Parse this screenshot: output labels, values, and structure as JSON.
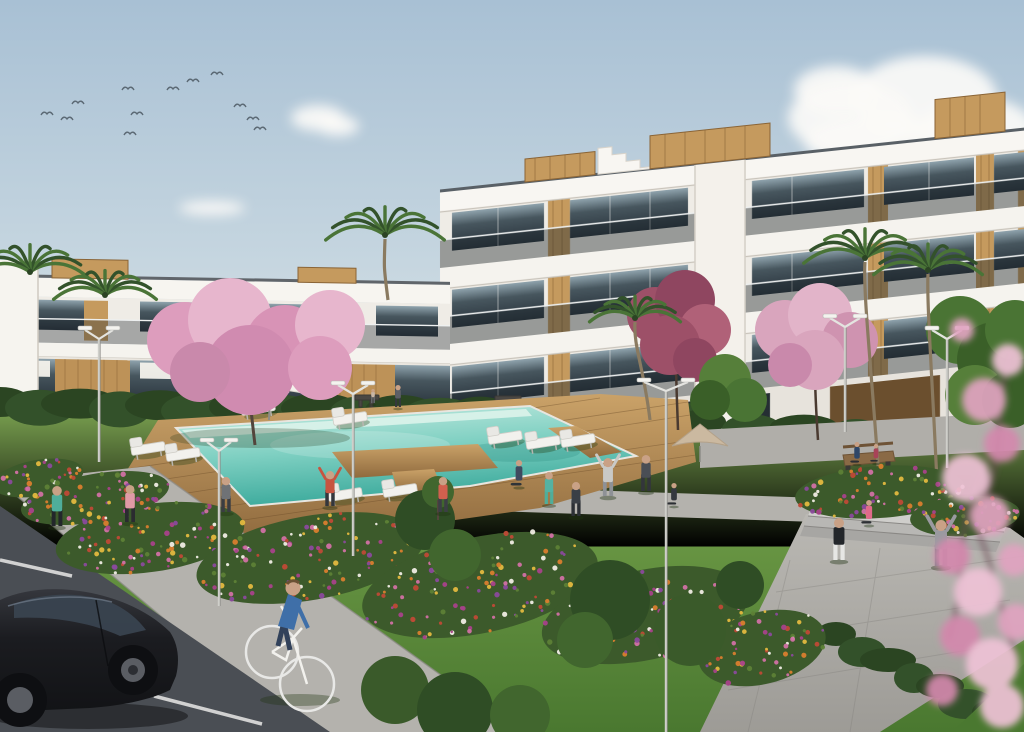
{
  "scene": {
    "description": "3D architectural rendering of a white modern apartment complex with communal lawn, swimming pool, flower beds, parking and people exercising"
  },
  "palette": {
    "sky_top": "#a8c0d4",
    "sky_mid": "#c6d6e0",
    "sky_horizon": "#e8ecec",
    "cloud": "#fbfaf7",
    "building_white": "#f6f4f0",
    "building_wall": "#efece6",
    "building_shadow": "#e3dfd8",
    "fascia": "#f8f6f2",
    "coping": "#596066",
    "glass_dark": "#2e3a41",
    "glass_light": "#9fb2ba",
    "wood": "#c59a5e",
    "wood_dark": "#8a6436",
    "lawn_light": "#83ad53",
    "lawn_dark": "#477530",
    "hedge_a": "#33512a",
    "hedge_b": "#2b4522",
    "flower_base": "#3c5a2b",
    "pool_light": "#c9ece3",
    "pool_deep": "#3fae9f",
    "pool_shelf": "#dff4ec",
    "deck_light": "#bf955f",
    "deck_dark": "#8f6a3e",
    "path_light": "#b6b4af",
    "path_mid": "#a5a39e",
    "asphalt": "#4a4e54",
    "paint_line": "#e9e9e7",
    "blossom_light": "#e7b6cd",
    "blossom_mid": "#d893b6",
    "blossom_deep": "#c06d96",
    "magenta_tree": "#9d5068",
    "car_body": "#1b1c20",
    "skin": "#c9a186"
  },
  "flower_colors": [
    "#d97e2e",
    "#e3b93f",
    "#d171a4",
    "#a8428a",
    "#bf4a36",
    "#f0ede4",
    "#8a4a9c",
    "#5d8136"
  ],
  "birds": [
    [
      47,
      113
    ],
    [
      67,
      118
    ],
    [
      78,
      102
    ],
    [
      128,
      88
    ],
    [
      137,
      113
    ],
    [
      173,
      88
    ],
    [
      193,
      80
    ],
    [
      240,
      105
    ],
    [
      253,
      118
    ],
    [
      130,
      133
    ],
    [
      217,
      73
    ],
    [
      260,
      128
    ]
  ],
  "clouds": [
    {
      "cx": 850,
      "cy": 118,
      "rx": 62,
      "ry": 36
    },
    {
      "cx": 925,
      "cy": 98,
      "rx": 72,
      "ry": 42
    },
    {
      "cx": 978,
      "cy": 128,
      "rx": 56,
      "ry": 30
    },
    {
      "cx": 888,
      "cy": 142,
      "rx": 84,
      "ry": 26
    },
    {
      "cx": 836,
      "cy": 90,
      "rx": 42,
      "ry": 24
    },
    {
      "cx": 588,
      "cy": 222,
      "rx": 42,
      "ry": 15
    },
    {
      "cx": 642,
      "cy": 215,
      "rx": 46,
      "ry": 17
    },
    {
      "cx": 692,
      "cy": 226,
      "rx": 36,
      "ry": 12
    },
    {
      "cx": 616,
      "cy": 233,
      "rx": 52,
      "ry": 11
    },
    {
      "cx": 318,
      "cy": 118,
      "rx": 27,
      "ry": 13
    },
    {
      "cx": 338,
      "cy": 126,
      "rx": 21,
      "ry": 10
    },
    {
      "cx": 212,
      "cy": 208,
      "rx": 33,
      "ry": 7
    },
    {
      "cx": 1004,
      "cy": 250,
      "rx": 46,
      "ry": 12
    }
  ],
  "hedges": [
    {
      "x0": 0,
      "x1": 700,
      "y": 404,
      "rx": 31,
      "ry": 15,
      "slope": 0.02,
      "step": 40
    },
    {
      "x0": 700,
      "x1": 1030,
      "y": 424,
      "rx": 26,
      "ry": 12,
      "slope": 0.045,
      "step": 52
    },
    {
      "x0": 836,
      "x1": 1030,
      "y": 636,
      "rx": 20,
      "ry": 12,
      "slope": 0.5,
      "step": 26
    }
  ],
  "flower_beds": [
    {
      "cx": 150,
      "cy": 538,
      "rx": 95,
      "ry": 34,
      "rot": -8,
      "n": 90
    },
    {
      "cx": 310,
      "cy": 558,
      "rx": 115,
      "ry": 42,
      "rot": -10,
      "n": 110
    },
    {
      "cx": 480,
      "cy": 585,
      "rx": 120,
      "ry": 48,
      "rot": -12,
      "n": 120
    },
    {
      "cx": 645,
      "cy": 615,
      "rx": 105,
      "ry": 45,
      "rot": -12,
      "n": 100
    },
    {
      "cx": 762,
      "cy": 648,
      "rx": 65,
      "ry": 36,
      "rot": -14,
      "n": 60
    },
    {
      "cx": 95,
      "cy": 498,
      "rx": 75,
      "ry": 24,
      "rot": -10,
      "n": 60
    },
    {
      "cx": 38,
      "cy": 478,
      "rx": 46,
      "ry": 18,
      "rot": -10,
      "n": 35
    },
    {
      "cx": 880,
      "cy": 492,
      "rx": 85,
      "ry": 26,
      "rot": -4,
      "n": 70
    },
    {
      "cx": 965,
      "cy": 516,
      "rx": 55,
      "ry": 20,
      "rot": -4,
      "n": 40
    }
  ],
  "loungers": [
    {
      "x": 258,
      "y": 408
    },
    {
      "x": 350,
      "y": 418
    },
    {
      "x": 148,
      "y": 448
    },
    {
      "x": 183,
      "y": 454
    },
    {
      "x": 505,
      "y": 437
    },
    {
      "x": 543,
      "y": 442
    },
    {
      "x": 345,
      "y": 494
    },
    {
      "x": 400,
      "y": 490
    },
    {
      "x": 578,
      "y": 440
    }
  ],
  "parking_lines": [
    [
      0,
      560,
      72,
      576
    ],
    [
      154,
      696,
      262,
      724
    ],
    [
      0,
      646,
      36,
      654
    ]
  ],
  "lamps": [
    {
      "x": 99,
      "top": 330,
      "bottom": 462,
      "arm": 14
    },
    {
      "x": 219,
      "top": 442,
      "bottom": 606,
      "arm": 12
    },
    {
      "x": 353,
      "top": 385,
      "bottom": 556,
      "arm": 15
    },
    {
      "x": 666,
      "top": 382,
      "bottom": 732,
      "arm": 22
    },
    {
      "x": 845,
      "top": 318,
      "bottom": 432,
      "arm": 15
    },
    {
      "x": 947,
      "top": 330,
      "bottom": 468,
      "arm": 15
    }
  ],
  "people": [
    {
      "name": "jogger-teal",
      "x": 57,
      "y": 526,
      "h": 40,
      "shirt": "#4fae9b",
      "pants": "#23272b",
      "type": "stand"
    },
    {
      "name": "jogger-pink",
      "x": 130,
      "y": 522,
      "h": 37,
      "shirt": "#e09aa6",
      "pants": "#2b2b30",
      "type": "stand"
    },
    {
      "name": "walker-deck",
      "x": 226,
      "y": 512,
      "h": 35,
      "shirt": "#6f7276",
      "pants": "#3a3d42",
      "type": "stand"
    },
    {
      "name": "stretcher-red",
      "x": 330,
      "y": 506,
      "h": 35,
      "shirt": "#c75440",
      "pants": "#33363c",
      "type": "armsup"
    },
    {
      "name": "walker-coral",
      "x": 443,
      "y": 512,
      "h": 35,
      "shirt": "#d2604e",
      "pants": "#3c3f45",
      "type": "stand"
    },
    {
      "name": "lounger-sitter",
      "x": 519,
      "y": 486,
      "h": 26,
      "shirt": "#3f4a5f",
      "pants": "#2e3338",
      "type": "seated"
    },
    {
      "name": "exerciser-teal",
      "x": 549,
      "y": 504,
      "h": 32,
      "shirt": "#54b2a2",
      "pants": "#4fae9b",
      "type": "stand"
    },
    {
      "name": "exerciser-track",
      "x": 576,
      "y": 516,
      "h": 34,
      "shirt": "#3a3f46",
      "pants": "#2c3036",
      "type": "stand"
    },
    {
      "name": "stretcher-hoodie",
      "x": 608,
      "y": 496,
      "h": 38,
      "shirt": "#c9c9c6",
      "pants": "#8e9196",
      "type": "armsup"
    },
    {
      "name": "exerciser-shorts",
      "x": 646,
      "y": 491,
      "h": 36,
      "shirt": "#4a4e55",
      "pants": "#33363b",
      "type": "stand"
    },
    {
      "name": "yoga-sitter",
      "x": 674,
      "y": 505,
      "h": 22,
      "shirt": "#34383f",
      "pants": "#2b2e33",
      "type": "seated"
    },
    {
      "name": "sitter-pink",
      "x": 869,
      "y": 524,
      "h": 24,
      "shirt": "#e06a8a",
      "pants": "#2e3135",
      "type": "seated"
    },
    {
      "name": "stander-black",
      "x": 839,
      "y": 560,
      "h": 42,
      "shirt": "#23262a",
      "pants": "#e6e6e4",
      "type": "stand"
    },
    {
      "name": "cheerer-gray",
      "x": 941,
      "y": 566,
      "h": 46,
      "shirt": "#9a9aa0",
      "pants": "#7e8187",
      "type": "armsup"
    },
    {
      "name": "bench-sitter-navy",
      "x": 857,
      "y": 463,
      "h": 21,
      "shirt": "#2e4668",
      "pants": "#2b2e33",
      "type": "seated"
    },
    {
      "name": "bench-sitter-red",
      "x": 876,
      "y": 462,
      "h": 18,
      "shirt": "#a84358",
      "pants": "#2b2e33",
      "type": "seated"
    },
    {
      "name": "distant-walker",
      "x": 398,
      "y": 407,
      "h": 22,
      "shirt": "#5d5f66",
      "pants": "#35383d",
      "type": "stand"
    },
    {
      "name": "distant-child",
      "x": 373,
      "y": 403,
      "h": 14,
      "shirt": "#c8b6a6",
      "pants": "#6a6d72",
      "type": "stand"
    }
  ]
}
